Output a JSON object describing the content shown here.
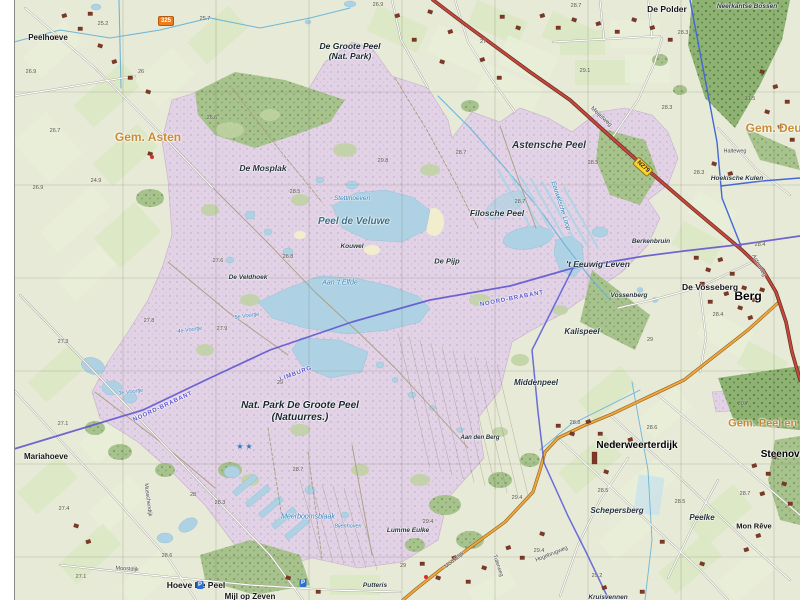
{
  "map": {
    "colors": {
      "heath": "#e2d2e5",
      "forest": "#a8c28d",
      "forest_dark": "#8db272",
      "water": "#aed2e3",
      "farmland": "#e3ecd3",
      "road_major": "#c9463a",
      "road_secondary": "#f2a73d",
      "boundary_province": "#6156cf",
      "boundary_municipal": "#4468d8",
      "label_water": "#2b7cb8",
      "label_municipality": "#c7872e"
    },
    "labels": [
      {
        "t": "Peelhoeve",
        "x": 48,
        "y": 38,
        "c": "place",
        "s": 8
      },
      {
        "t": "De Groote Peel",
        "x": 350,
        "y": 46,
        "c": "natbig",
        "s": 8.5
      },
      {
        "t": "(Nat. Park)",
        "x": 350,
        "y": 56,
        "c": "natbig",
        "s": 8.5
      },
      {
        "t": "De Polder",
        "x": 667,
        "y": 9,
        "c": "place",
        "s": 8.5
      },
      {
        "t": "Neerkantse Bossen",
        "x": 747,
        "y": 7,
        "c": "nat",
        "s": 6.5
      },
      {
        "t": "Gem. Asten",
        "x": 148,
        "y": 137,
        "c": "gem",
        "s": 12
      },
      {
        "t": "Gem. Deurne",
        "x": 783,
        "y": 128,
        "c": "gem",
        "s": 12
      },
      {
        "t": "Gem. Peel en Maas",
        "x": 778,
        "y": 424,
        "c": "gem",
        "s": 11
      },
      {
        "t": "Hoekische Kulen",
        "x": 737,
        "y": 179,
        "c": "nat",
        "s": 6.5
      },
      {
        "t": "Halteweg",
        "x": 735,
        "y": 152,
        "c": "road",
        "s": 5.5
      },
      {
        "t": "Astensche Peel",
        "x": 549,
        "y": 146,
        "c": "nat",
        "s": 10
      },
      {
        "t": "Meijelweg",
        "x": 601,
        "y": 117,
        "c": "road",
        "s": 6,
        "r": 43
      },
      {
        "t": "De Mosplak",
        "x": 263,
        "y": 168,
        "c": "nat",
        "s": 8.5
      },
      {
        "t": "Stettinoeven",
        "x": 352,
        "y": 199,
        "c": "water",
        "s": 6.5
      },
      {
        "t": "Peel de Veluwe",
        "x": 354,
        "y": 222,
        "c": "waterbig",
        "s": 10
      },
      {
        "t": "Kouwel",
        "x": 352,
        "y": 247,
        "c": "nat",
        "s": 6.5
      },
      {
        "t": "Filosche Peel",
        "x": 497,
        "y": 213,
        "c": "nat",
        "s": 8.5
      },
      {
        "t": "De Pijp",
        "x": 447,
        "y": 261,
        "c": "nat",
        "s": 7.5
      },
      {
        "t": "'t Eeuwig Leven",
        "x": 598,
        "y": 264,
        "c": "nat",
        "s": 8.5
      },
      {
        "t": "Eeuwelsche Loop",
        "x": 560,
        "y": 206,
        "c": "water",
        "s": 6.5,
        "r": 72
      },
      {
        "t": "Berkenbruin",
        "x": 651,
        "y": 242,
        "c": "nat",
        "s": 6.5
      },
      {
        "t": "Aan 't Elfde",
        "x": 340,
        "y": 283,
        "c": "water",
        "s": 7
      },
      {
        "t": "De Veldhoek",
        "x": 248,
        "y": 278,
        "c": "nat",
        "s": 6.5
      },
      {
        "t": "Berg",
        "x": 748,
        "y": 296,
        "c": "placebig",
        "s": 12
      },
      {
        "t": "De Vosseberg",
        "x": 710,
        "y": 287,
        "c": "place",
        "s": 8.5
      },
      {
        "t": "Astenweg",
        "x": 758,
        "y": 266,
        "c": "road",
        "s": 5.5,
        "r": 62
      },
      {
        "t": "Vossenberg",
        "x": 629,
        "y": 296,
        "c": "nat",
        "s": 6.5
      },
      {
        "t": "Kalispeel",
        "x": 582,
        "y": 332,
        "c": "nat",
        "s": 8
      },
      {
        "t": "Middenpeel",
        "x": 536,
        "y": 383,
        "c": "nat",
        "s": 8
      },
      {
        "t": "NOORD-BRABANT",
        "x": 163,
        "y": 407,
        "c": "bound",
        "s": 6,
        "r": -25
      },
      {
        "t": "NOORD-BRABANT",
        "x": 512,
        "y": 299,
        "c": "bound",
        "s": 6,
        "r": -11
      },
      {
        "t": "LIMBURG",
        "x": 296,
        "y": 374,
        "c": "bound",
        "s": 6,
        "r": -20
      },
      {
        "t": "Nat. Park De Groote Peel",
        "x": 300,
        "y": 406,
        "c": "natbig",
        "s": 10
      },
      {
        "t": "(Natuurres.)",
        "x": 300,
        "y": 418,
        "c": "natbig",
        "s": 10
      },
      {
        "t": "Aan den Berg",
        "x": 480,
        "y": 438,
        "c": "nat",
        "s": 6
      },
      {
        "t": "Nederweerterdijk",
        "x": 637,
        "y": 446,
        "c": "placebig",
        "s": 10
      },
      {
        "t": "Steenoven",
        "x": 786,
        "y": 455,
        "c": "placebig",
        "s": 10
      },
      {
        "t": "Schepersberg",
        "x": 617,
        "y": 511,
        "c": "nat",
        "s": 8
      },
      {
        "t": "Peelke",
        "x": 702,
        "y": 518,
        "c": "nat",
        "s": 8
      },
      {
        "t": "Mon Rêve",
        "x": 754,
        "y": 526,
        "c": "place",
        "s": 7.5
      },
      {
        "t": "Mariahoeve",
        "x": 46,
        "y": 457,
        "c": "place",
        "s": 8
      },
      {
        "t": "Musschendijk",
        "x": 147,
        "y": 500,
        "c": "road",
        "s": 5.5,
        "r": 83
      },
      {
        "t": "Moostdijk",
        "x": 127,
        "y": 570,
        "c": "road",
        "s": 5.5,
        "r": 4
      },
      {
        "t": "Hoeve De Peel",
        "x": 196,
        "y": 585,
        "c": "place",
        "s": 8.5
      },
      {
        "t": "Mijl op Zeven",
        "x": 250,
        "y": 597,
        "c": "place",
        "s": 8
      },
      {
        "t": "Meerboomsblaak",
        "x": 308,
        "y": 517,
        "c": "water",
        "s": 7
      },
      {
        "t": "Bijenhoven",
        "x": 348,
        "y": 527,
        "c": "water",
        "s": 5.5
      },
      {
        "t": "Lumme Eulke",
        "x": 408,
        "y": 531,
        "c": "nat",
        "s": 6.5
      },
      {
        "t": "Putteris",
        "x": 375,
        "y": 586,
        "c": "nat",
        "s": 6.5
      },
      {
        "t": "Moostdijk",
        "x": 455,
        "y": 561,
        "c": "road",
        "s": 5.5,
        "r": -38
      },
      {
        "t": "Tuterweg",
        "x": 497,
        "y": 566,
        "c": "road",
        "s": 5.5,
        "r": 72
      },
      {
        "t": "Hogebrugweg",
        "x": 552,
        "y": 555,
        "c": "road",
        "s": 5.5,
        "r": -22
      },
      {
        "t": "Kruisvennen",
        "x": 608,
        "y": 598,
        "c": "nat",
        "s": 6.5
      },
      {
        "t": "4e Voortje",
        "x": 190,
        "y": 331,
        "c": "water",
        "s": 5.5,
        "r": -8
      },
      {
        "t": "5e Voortje",
        "x": 247,
        "y": 317,
        "c": "water",
        "s": 5.5,
        "r": -8
      },
      {
        "t": "3e Voortje",
        "x": 131,
        "y": 393,
        "c": "water",
        "s": 5.5,
        "r": -8
      }
    ],
    "badges": [
      {
        "t": "325",
        "x": 166,
        "y": 21,
        "type": "orange"
      },
      {
        "t": "N279",
        "x": 643,
        "y": 167,
        "type": "yellow",
        "r": 42
      }
    ],
    "markers": {
      "stars": {
        "glyph": "★",
        "points": [
          {
            "x": 240,
            "y": 447
          },
          {
            "x": 249,
            "y": 447
          }
        ]
      },
      "parking": {
        "glyph": "P",
        "points": [
          {
            "x": 200,
            "y": 585
          },
          {
            "x": 303,
            "y": 583
          }
        ]
      },
      "red_dots": [
        {
          "x": 152,
          "y": 157
        },
        {
          "x": 426,
          "y": 577
        }
      ]
    },
    "spot_heights": [
      [
        31,
        72,
        "26.9"
      ],
      [
        103,
        24,
        "25.2"
      ],
      [
        205,
        19,
        "25.7"
      ],
      [
        141,
        72,
        "26"
      ],
      [
        55,
        131,
        "26.7"
      ],
      [
        38,
        188,
        "26.9"
      ],
      [
        96,
        181,
        "24.9"
      ],
      [
        212,
        118,
        "26.6"
      ],
      [
        295,
        192,
        "28.5"
      ],
      [
        288,
        257,
        "26.8"
      ],
      [
        218,
        261,
        "27.6"
      ],
      [
        383,
        161,
        "29.8"
      ],
      [
        461,
        153,
        "28.7"
      ],
      [
        378,
        5,
        "26.9"
      ],
      [
        483,
        42,
        "27"
      ],
      [
        576,
        6,
        "28.7"
      ],
      [
        683,
        33,
        "28.3"
      ],
      [
        585,
        71,
        "29.1"
      ],
      [
        750,
        99,
        "31.5"
      ],
      [
        667,
        108,
        "28.3"
      ],
      [
        593,
        163,
        "28.5"
      ],
      [
        699,
        173,
        "28.3"
      ],
      [
        760,
        245,
        "28.4"
      ],
      [
        718,
        315,
        "28.4"
      ],
      [
        520,
        202,
        "28.7"
      ],
      [
        650,
        340,
        "29"
      ],
      [
        280,
        383,
        "29"
      ],
      [
        298,
        470,
        "28.7"
      ],
      [
        149,
        321,
        "27.8"
      ],
      [
        222,
        329,
        "27.9"
      ],
      [
        63,
        342,
        "27.3"
      ],
      [
        63,
        424,
        "27.1"
      ],
      [
        64,
        509,
        "27.4"
      ],
      [
        81,
        577,
        "27.1"
      ],
      [
        193,
        495,
        "28"
      ],
      [
        220,
        503,
        "28.3"
      ],
      [
        167,
        556,
        "28.6"
      ],
      [
        428,
        522,
        "29.4"
      ],
      [
        517,
        498,
        "29.4"
      ],
      [
        403,
        566,
        "29"
      ],
      [
        652,
        428,
        "28.6"
      ],
      [
        603,
        491,
        "28.5"
      ],
      [
        680,
        502,
        "28.5"
      ],
      [
        745,
        494,
        "28.7"
      ],
      [
        597,
        576,
        "29.2"
      ],
      [
        575,
        423,
        "28.8"
      ],
      [
        743,
        404,
        "30.7"
      ],
      [
        539,
        551,
        "29.4"
      ]
    ]
  }
}
